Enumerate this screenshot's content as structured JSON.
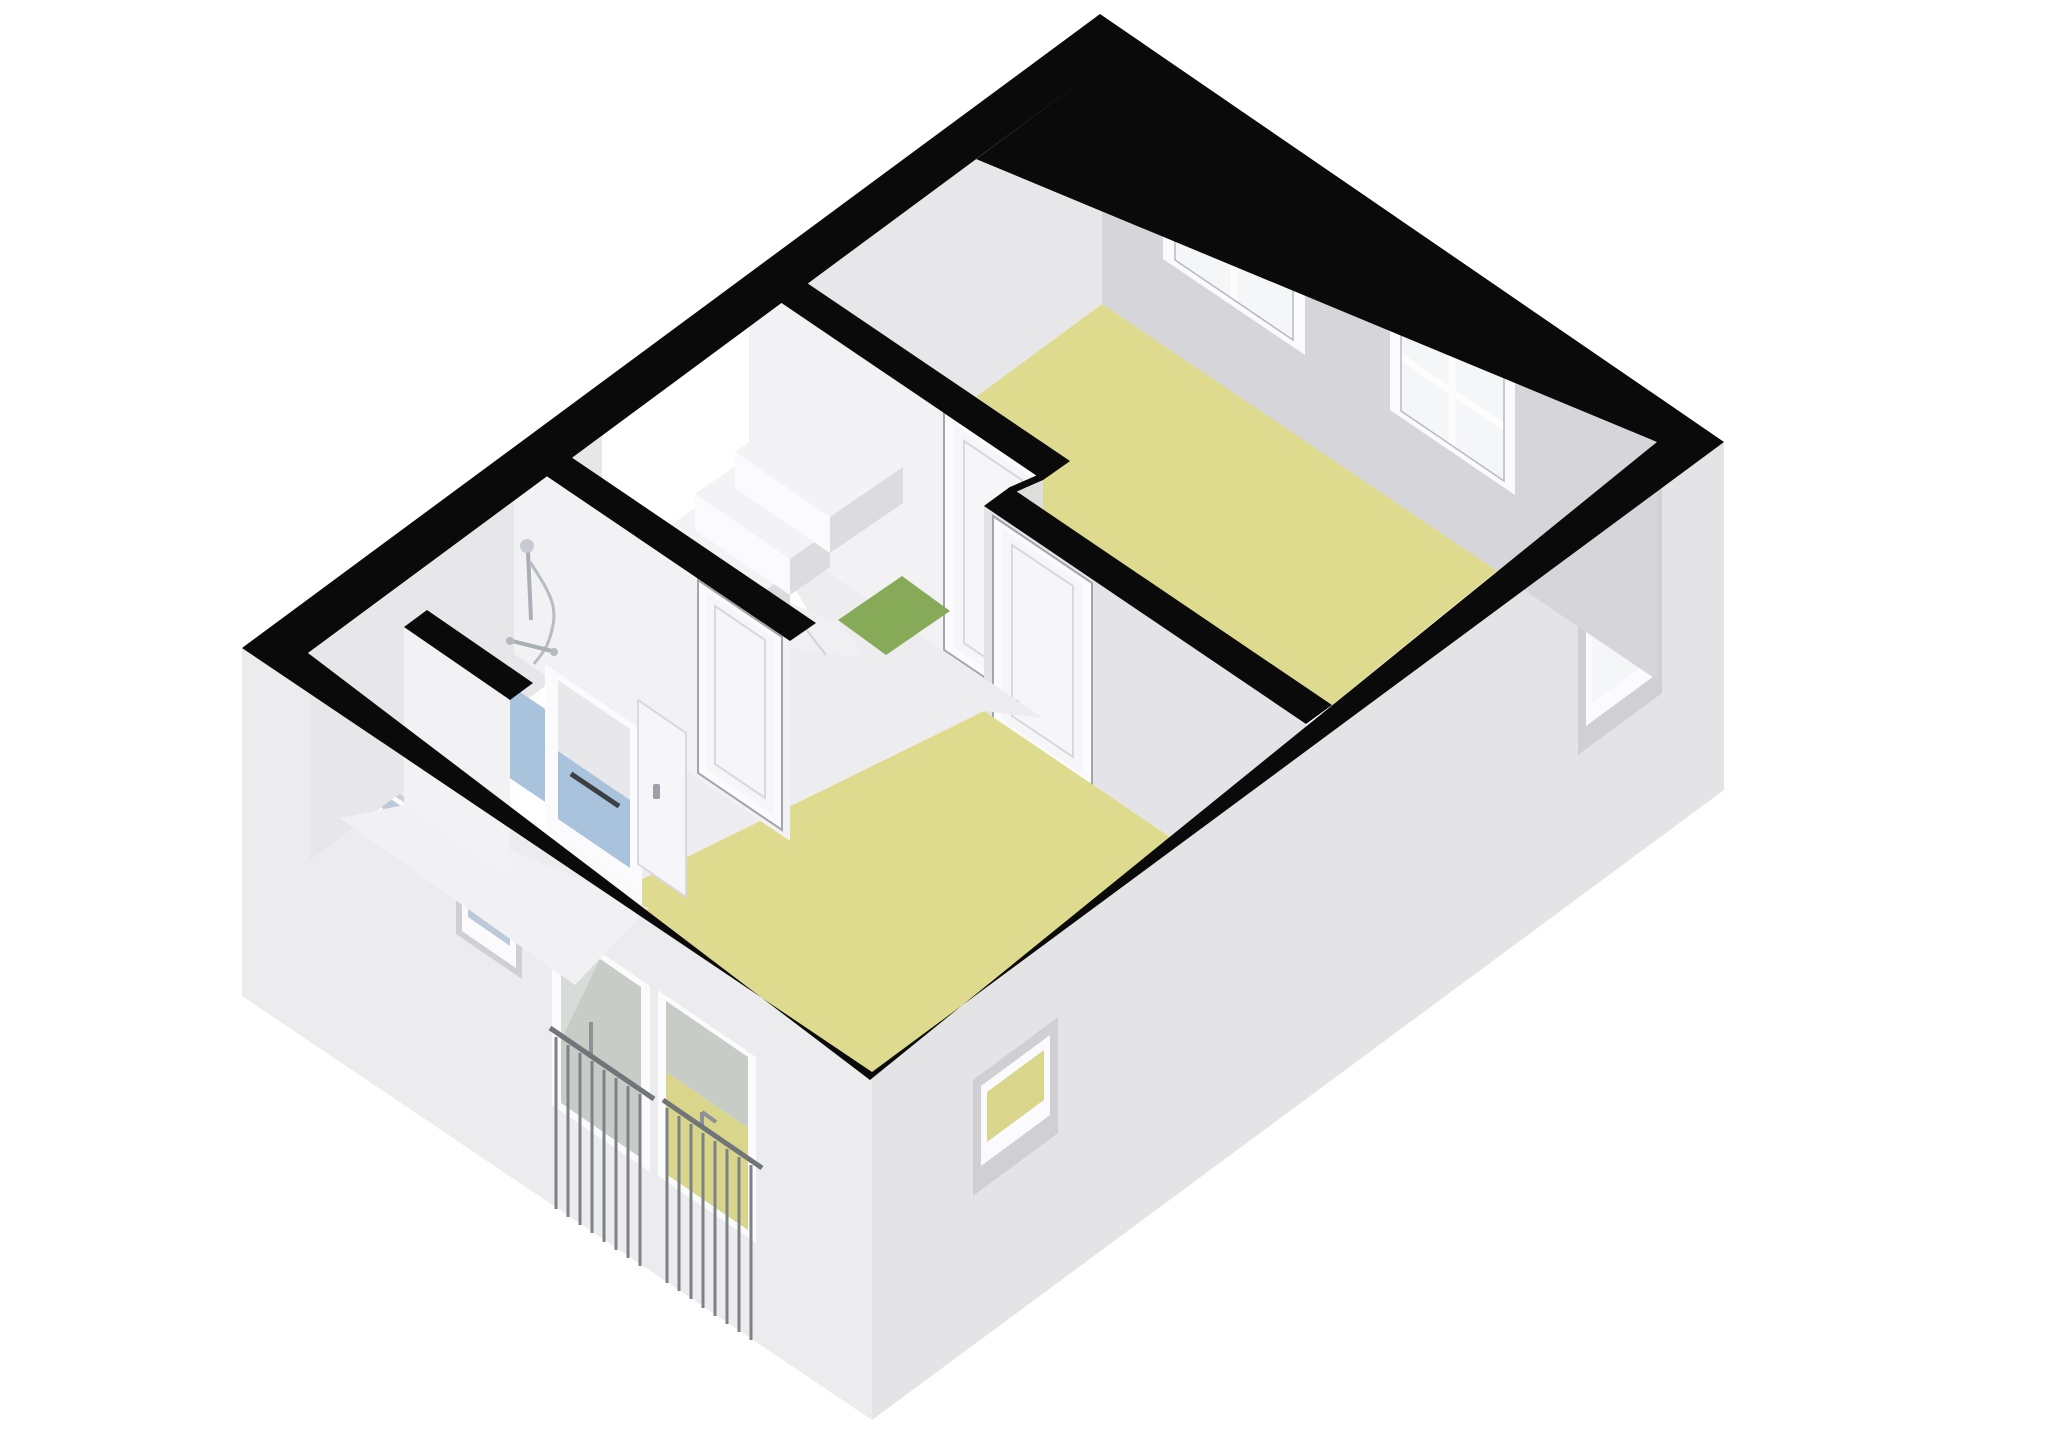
{
  "scene": {
    "type": "3d-floorplan-cutaway",
    "background": "#ffffff",
    "colors": {
      "wall_cut_black": "#0a0a0a",
      "ext_face_left": "#ececee",
      "ext_face_right": "#e4e4e6",
      "wall_ne_inner": "#d6d6da",
      "wall_nw_inner": "#e7e7ea",
      "wall_sw_face": "#f2f2f5",
      "wall_sw_face_dim": "#e4e4e8",
      "wall_jog": "#dededd",
      "floor_yellow": "#dedb8e",
      "floor_yellow_dim": "#d7d389",
      "floor_hall": "#ededf0",
      "floor_corridor": "#f1f1f4",
      "floor_bathroom_blue": "#a9c3dc",
      "mat_green": "#87aa58",
      "drain_dark": "#3c4045",
      "window_glass": "#f4f6f8",
      "window_glass_blue": "#bcc9da",
      "glass_balcony_gray": "#c7cdc6",
      "glass_balcony_yellow": "#d9d58a",
      "door_panel": "#f6f6f8",
      "threshold_white": "#fafafa",
      "step_top": "#f3f3f5",
      "step_front": "#fbfbfd",
      "step_side": "#dcdcdf",
      "niche_reveal": "#d0d0d4",
      "frame_white": "#fbfbfd",
      "railing_metal": "#70757a",
      "shower_chrome": "#c6cbd1"
    },
    "rooms": [
      {
        "id": "room-upper-right",
        "floor_color_key": "floor_yellow",
        "windows": 2,
        "doors": 1
      },
      {
        "id": "room-lower",
        "floor_color_key": "floor_yellow",
        "doors": 2,
        "balcony_doors": 2
      },
      {
        "id": "bathroom",
        "floor_color_key": "floor_bathroom_blue",
        "fixtures": [
          "shower-set",
          "floor-drain",
          "sliding-door"
        ]
      },
      {
        "id": "hall-landing",
        "floor_color_key": "floor_hall",
        "features": [
          "stairs-with-winders",
          "green-mat",
          "stairwell-void"
        ]
      }
    ],
    "features": {
      "ne_wall_windows": 2,
      "right_wall_windows": 2,
      "small_facade_windows": 2,
      "french_balcony_doors": 2,
      "railings": 2,
      "interior_doors": 4,
      "stairs": 1
    }
  }
}
